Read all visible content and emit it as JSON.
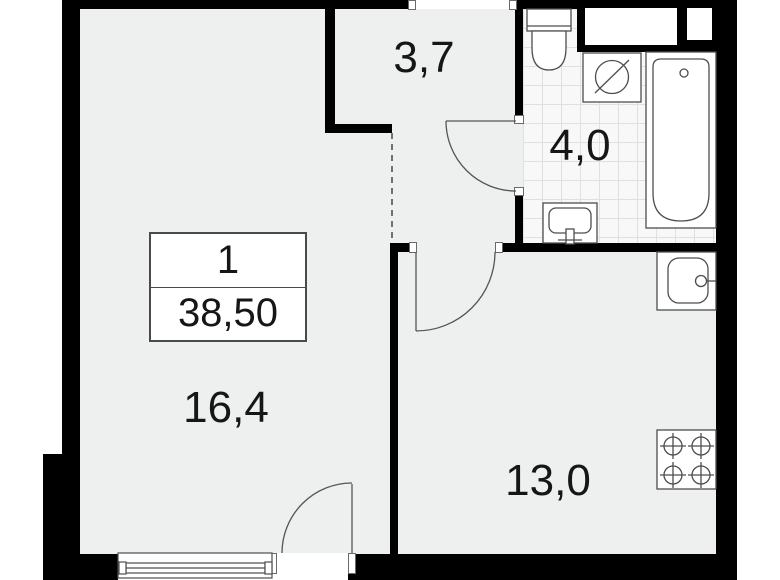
{
  "floorplan": {
    "type": "apartment-floor-plan",
    "title_block": {
      "room_count": "1",
      "total_area": "38,50"
    },
    "rooms": {
      "hallway": {
        "name": "hallway",
        "area": "3,7"
      },
      "bathroom": {
        "name": "bathroom",
        "area": "4,0"
      },
      "living_room": {
        "name": "living-room",
        "area": "16,4"
      },
      "kitchen": {
        "name": "kitchen",
        "area": "13,0"
      }
    },
    "fixtures": [
      "toilet",
      "washing-machine",
      "bathtub",
      "bathroom-sink",
      "kitchen-counter-sink",
      "stove-4-burner",
      "window",
      "balcony-door",
      "kitchen-door",
      "bathroom-door",
      "entrance-opening",
      "ventilation-shafts"
    ],
    "colors": {
      "wall": "#000000",
      "floor": "#edf0ef",
      "tile_background": "#f7f8f7",
      "tile_grid_line": "#dde1e0",
      "fixture_line": "#4d4d4d",
      "background": "#ffffff"
    }
  }
}
